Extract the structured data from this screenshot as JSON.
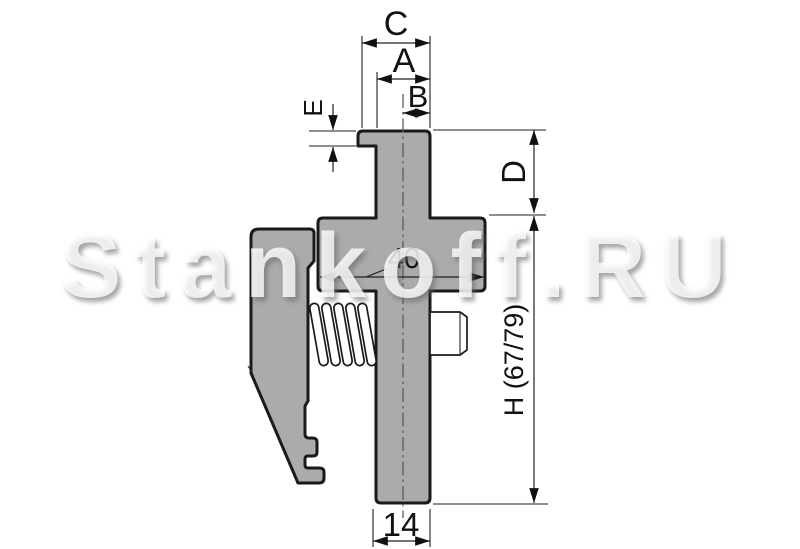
{
  "watermark": "Stankoff.RU",
  "dims": {
    "c": "C",
    "a": "A",
    "b": "B",
    "e": "E",
    "d": "D",
    "h": "H (67/79)",
    "cross_width": "40",
    "shank_width": "14"
  },
  "colors": {
    "body_fill": "#ababab",
    "outline": "#1a1a1a",
    "dim_line": "#1f1f1f",
    "centerline": "#5a5a5a",
    "background": "#ffffff",
    "watermark": "#ffffff"
  }
}
